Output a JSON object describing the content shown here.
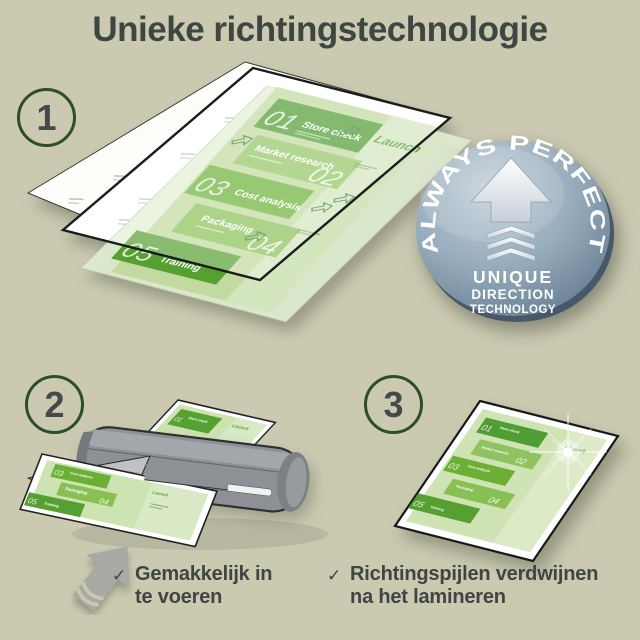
{
  "title": "Unieke richtingstechnologie",
  "steps": {
    "one": {
      "number": "1"
    },
    "two": {
      "number": "2",
      "caption": {
        "check": "✓",
        "line1": "Gemakkelijk in",
        "line2": "te voeren"
      }
    },
    "three": {
      "number": "3",
      "caption": {
        "check": "✓",
        "line1": "Richtingspijlen verdwijnen",
        "line2": "na het lamineren"
      }
    }
  },
  "badge": {
    "arc": "ALWAYS PERFECT!",
    "line1": "UNIQUE",
    "line2": "DIRECTION",
    "line3": "TECHNOLOGY"
  },
  "doc": {
    "launch": "Launch",
    "bands": [
      {
        "num": "01",
        "label": "Store check"
      },
      {
        "num": "02",
        "label": "Market research"
      },
      {
        "num": "03",
        "label": "Cost analysis"
      },
      {
        "num": "04",
        "label": "Packaging"
      },
      {
        "num": "05",
        "label": "Training"
      }
    ]
  },
  "colors": {
    "background": "#cbcab1",
    "text": "#3e4542",
    "circle_green": "#2c4e2a",
    "band_dark_green": "#4f9d33",
    "band_mid_green": "#6bb035",
    "band_light_green": "#88c053",
    "doc_base_green": "#c2da9f",
    "badge_blue": "#8aa0b2",
    "laminator_gray": "#8d9195",
    "arrow_gray": "#a9aaa4"
  }
}
